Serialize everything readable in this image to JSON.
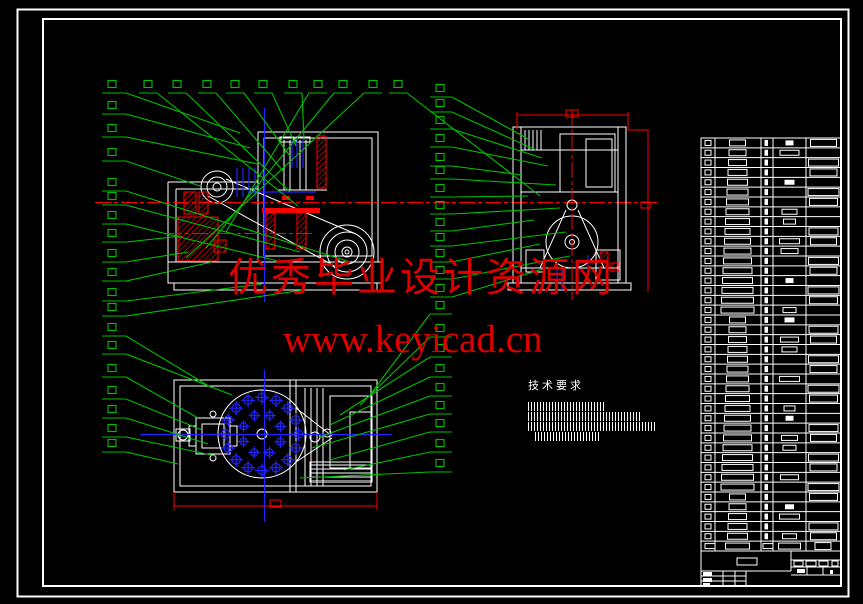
{
  "watermark": {
    "line1": "优秀毕业设计资源网",
    "line2": "www.keyicad.cn",
    "color": "#de0000"
  },
  "tech_requirements": {
    "title": "技术要求",
    "illegible_line_count": 4
  },
  "parts_table": {
    "data_rows": 42,
    "columns": 5,
    "header_row_at_bottom": true,
    "text_illegible": true
  },
  "views": {
    "front_view": "assembly front section view",
    "side_view": "assembly side section view",
    "plan_view": "assembly top view with bolt circle"
  },
  "colors": {
    "background": "#000000",
    "outline": "#ffffff",
    "leader_green": "#00c000",
    "centerline_red": "#ff0000",
    "centerline_blue": "#2323ff",
    "watermark_red": "#de0000"
  }
}
